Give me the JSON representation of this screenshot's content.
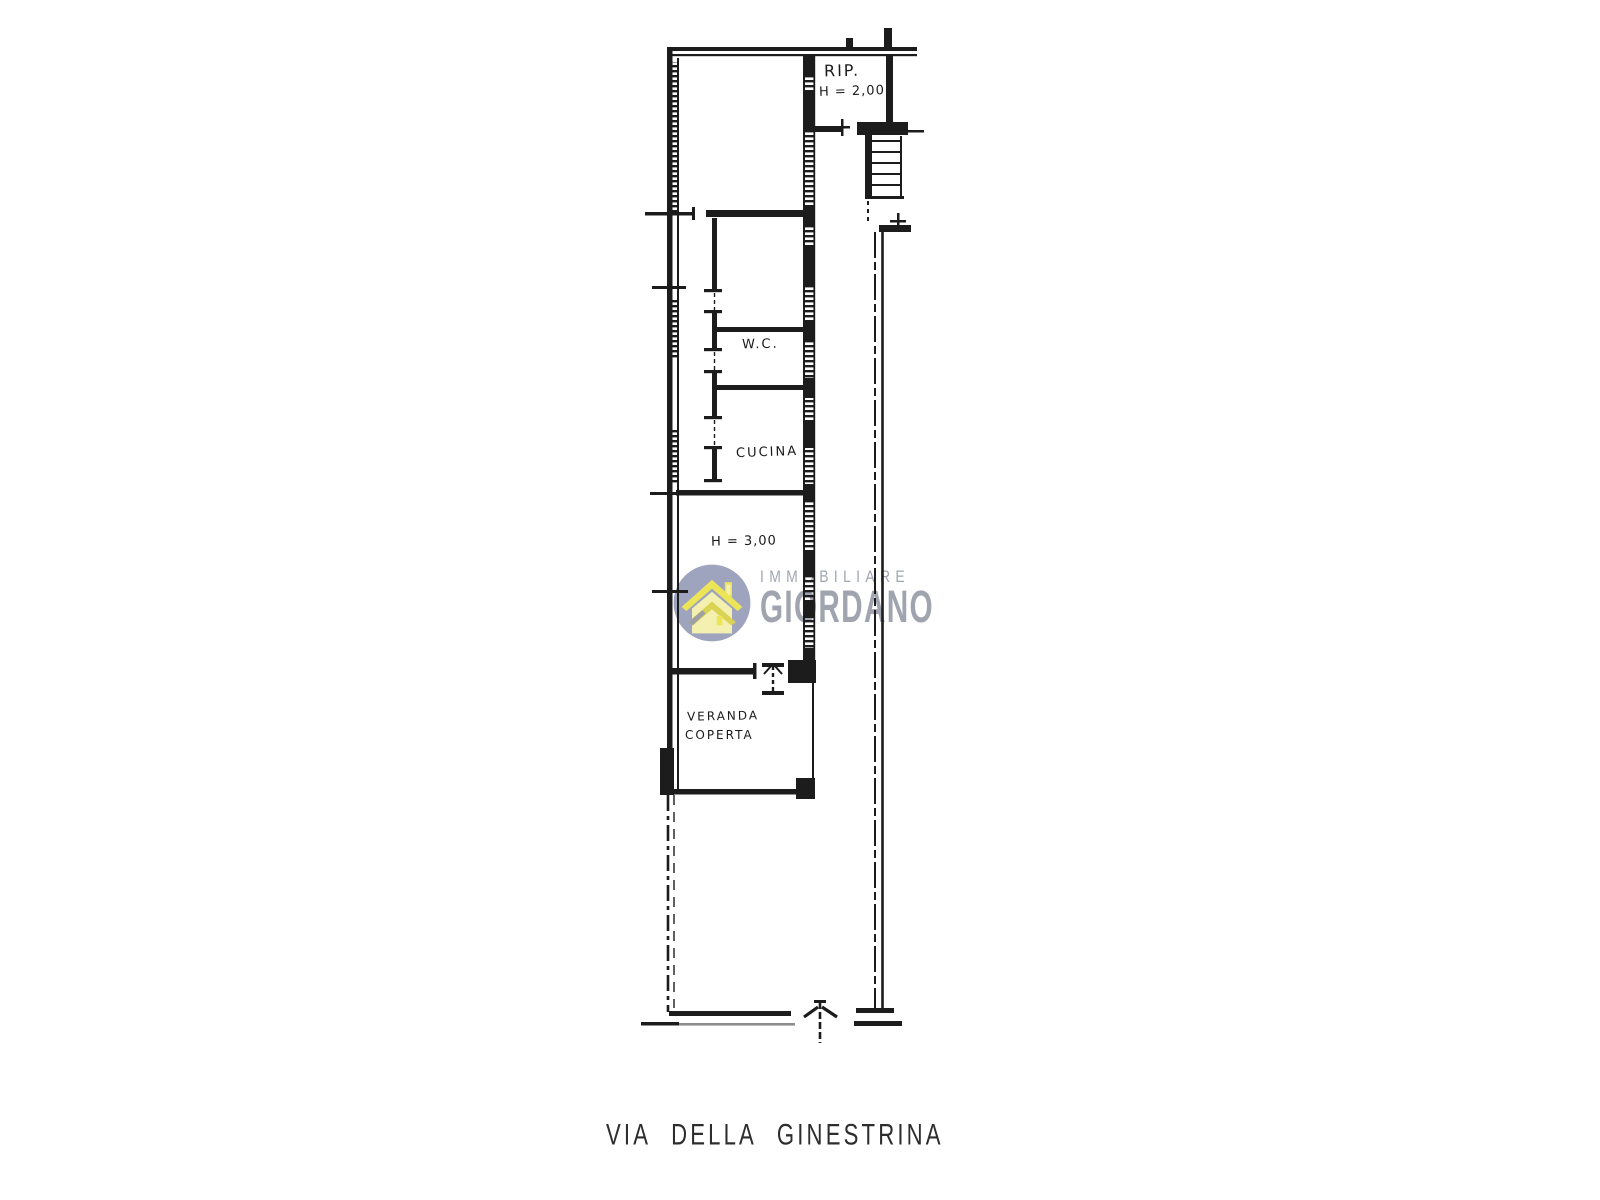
{
  "page": {
    "background": "#ffffff",
    "type_note": "hand-drawn real estate floor plan"
  },
  "plan": {
    "labels": {
      "rip": "RIP.",
      "rip_height": "H = 2,00",
      "wc": "W.C.",
      "cucina": "CUCINA",
      "main_height": "H = 3,00",
      "veranda_line1": "VERANDA",
      "veranda_line2": "COPERTA"
    },
    "street_label": "VIA DELLA GINESTRINA"
  },
  "watermark": {
    "brand_top": "IMMOBILIARE",
    "brand_bottom": "GIORDANO",
    "colors": {
      "circle": "#9aa0bb",
      "house_stroke": "#e9e14d",
      "house_fill": "#f4f1ac",
      "roof_shadow": "#8d93ae",
      "text": "#9aa0ab"
    }
  },
  "colors": {
    "ink": "#1c1c1c",
    "muted_line": "#8d8d8d"
  }
}
